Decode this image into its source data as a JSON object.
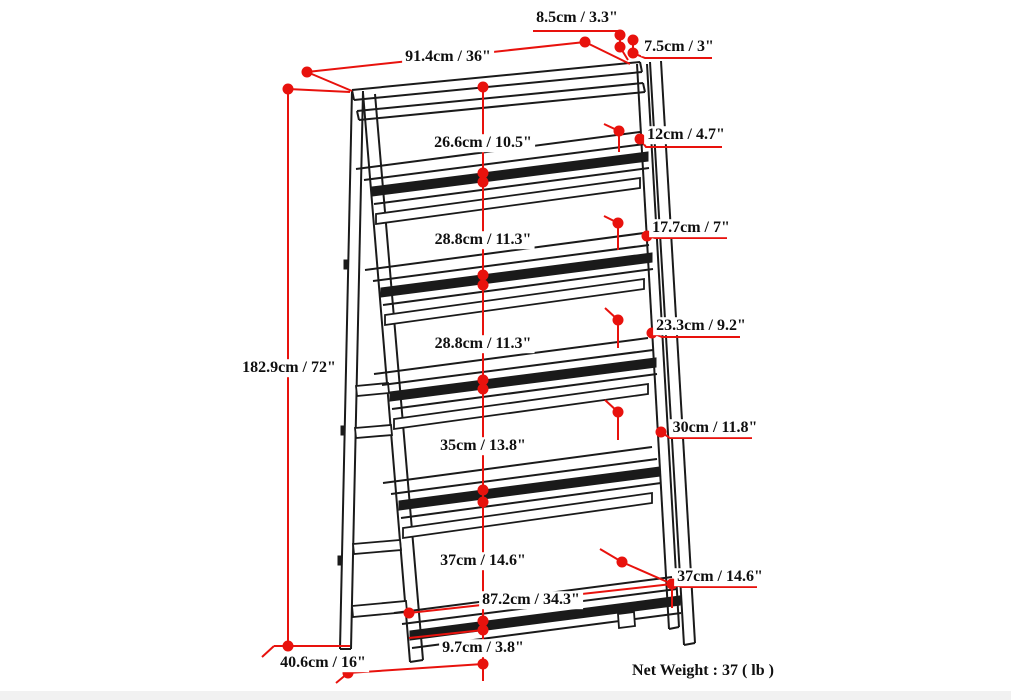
{
  "diagram": {
    "type": "product-dimension-diagram",
    "product": "5-shelf ladder bookshelf",
    "colors": {
      "dimension_red": "#e8120d",
      "line_black": "#1a1a1a",
      "background": "#ffffff"
    },
    "dimensions": {
      "overall_width": "91.4cm / 36\"",
      "top_back_depth": "8.5cm / 3.3\"",
      "top_leg_width": "7.5cm / 3\"",
      "overall_height": "182.9cm / 72\"",
      "shelf_spacings": [
        "26.6cm / 10.5\"",
        "28.8cm / 11.3\"",
        "28.8cm / 11.3\"",
        "35cm / 13.8\"",
        "37cm / 14.6\""
      ],
      "shelf_depths": [
        "12cm / 4.7\"",
        "17.7cm / 7\"",
        "23.3cm / 9.2\"",
        "30cm / 11.8\"",
        "37cm / 14.6\""
      ],
      "bottom_shelf_width": "87.2cm / 34.3\"",
      "foot_height": "9.7cm / 3.8\"",
      "overall_depth": "40.6cm / 16\"",
      "net_weight": "Net Weight : 37 ( lb )"
    }
  }
}
